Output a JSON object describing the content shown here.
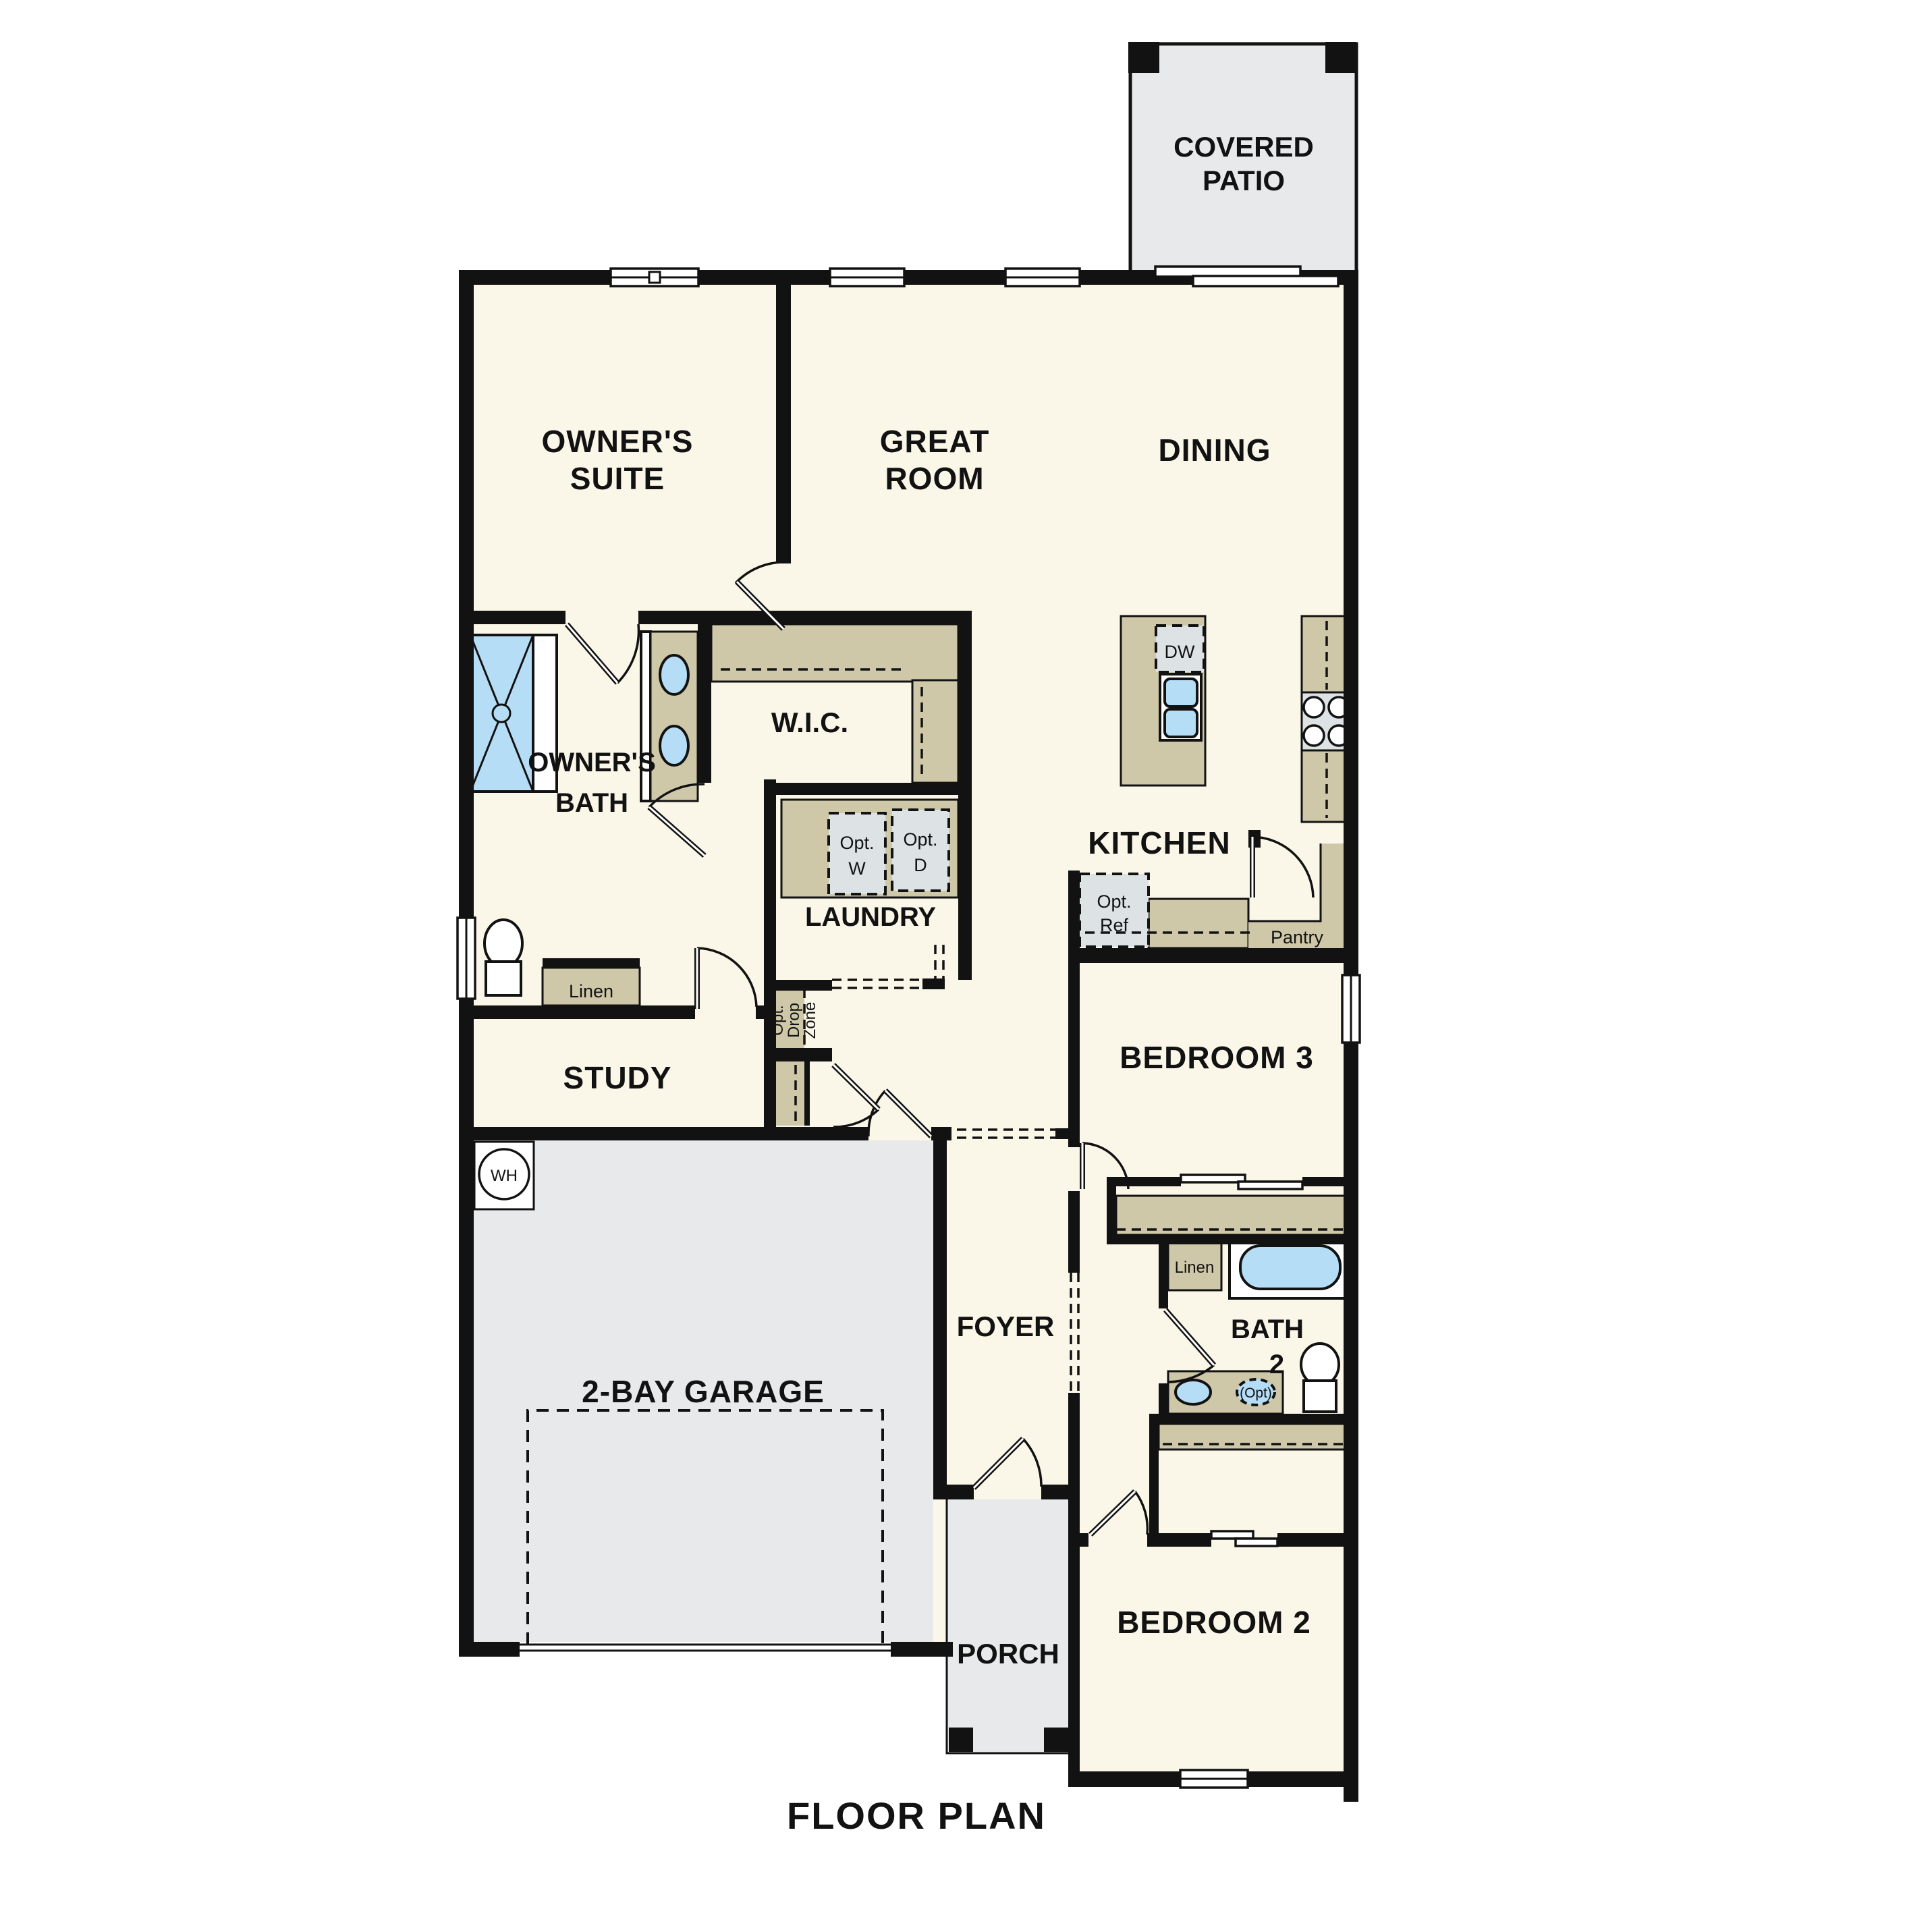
{
  "title": "FLOOR PLAN",
  "colors": {
    "background": "#ffffff",
    "wall": "#121212",
    "floor_cream": "#faf6e8",
    "exterior_gray": "#e8e9ea",
    "cabinet_tan": "#cfc8a8",
    "appliance_gray": "#dde2e4",
    "fixture_blue": "#b5ddf6"
  },
  "rooms": {
    "covered_patio": {
      "line1": "COVERED",
      "line2": "PATIO"
    },
    "owners_suite": {
      "line1": "OWNER'S",
      "line2": "SUITE"
    },
    "great_room": {
      "line1": "GREAT",
      "line2": "ROOM"
    },
    "dining": {
      "label": "DINING"
    },
    "owners_bath": {
      "line1": "OWNER'S",
      "line2": "BATH"
    },
    "wic": {
      "label": "W.I.C."
    },
    "laundry": {
      "label": "LAUNDRY"
    },
    "kitchen": {
      "label": "KITCHEN"
    },
    "pantry": {
      "label": "Pantry"
    },
    "study": {
      "label": "STUDY"
    },
    "bedroom3": {
      "label": "BEDROOM 3"
    },
    "foyer": {
      "label": "FOYER"
    },
    "bath2": {
      "line1": "BATH",
      "line2": "2"
    },
    "garage": {
      "label": "2-BAY GARAGE"
    },
    "porch": {
      "label": "PORCH"
    },
    "bedroom2": {
      "label": "BEDROOM 2"
    }
  },
  "fixtures": {
    "linen_owners": "Linen",
    "linen_bath2": "Linen",
    "dishwasher": "DW",
    "washer": {
      "line1": "Opt.",
      "line2": "W"
    },
    "dryer": {
      "line1": "Opt.",
      "line2": "D"
    },
    "refrigerator": {
      "line1": "Opt.",
      "line2": "Ref"
    },
    "water_heater": "WH",
    "optional_sink": "(Opt)",
    "drop_zone": {
      "line1": "Opt.",
      "line2": "Drop",
      "line3": "Zone"
    }
  }
}
